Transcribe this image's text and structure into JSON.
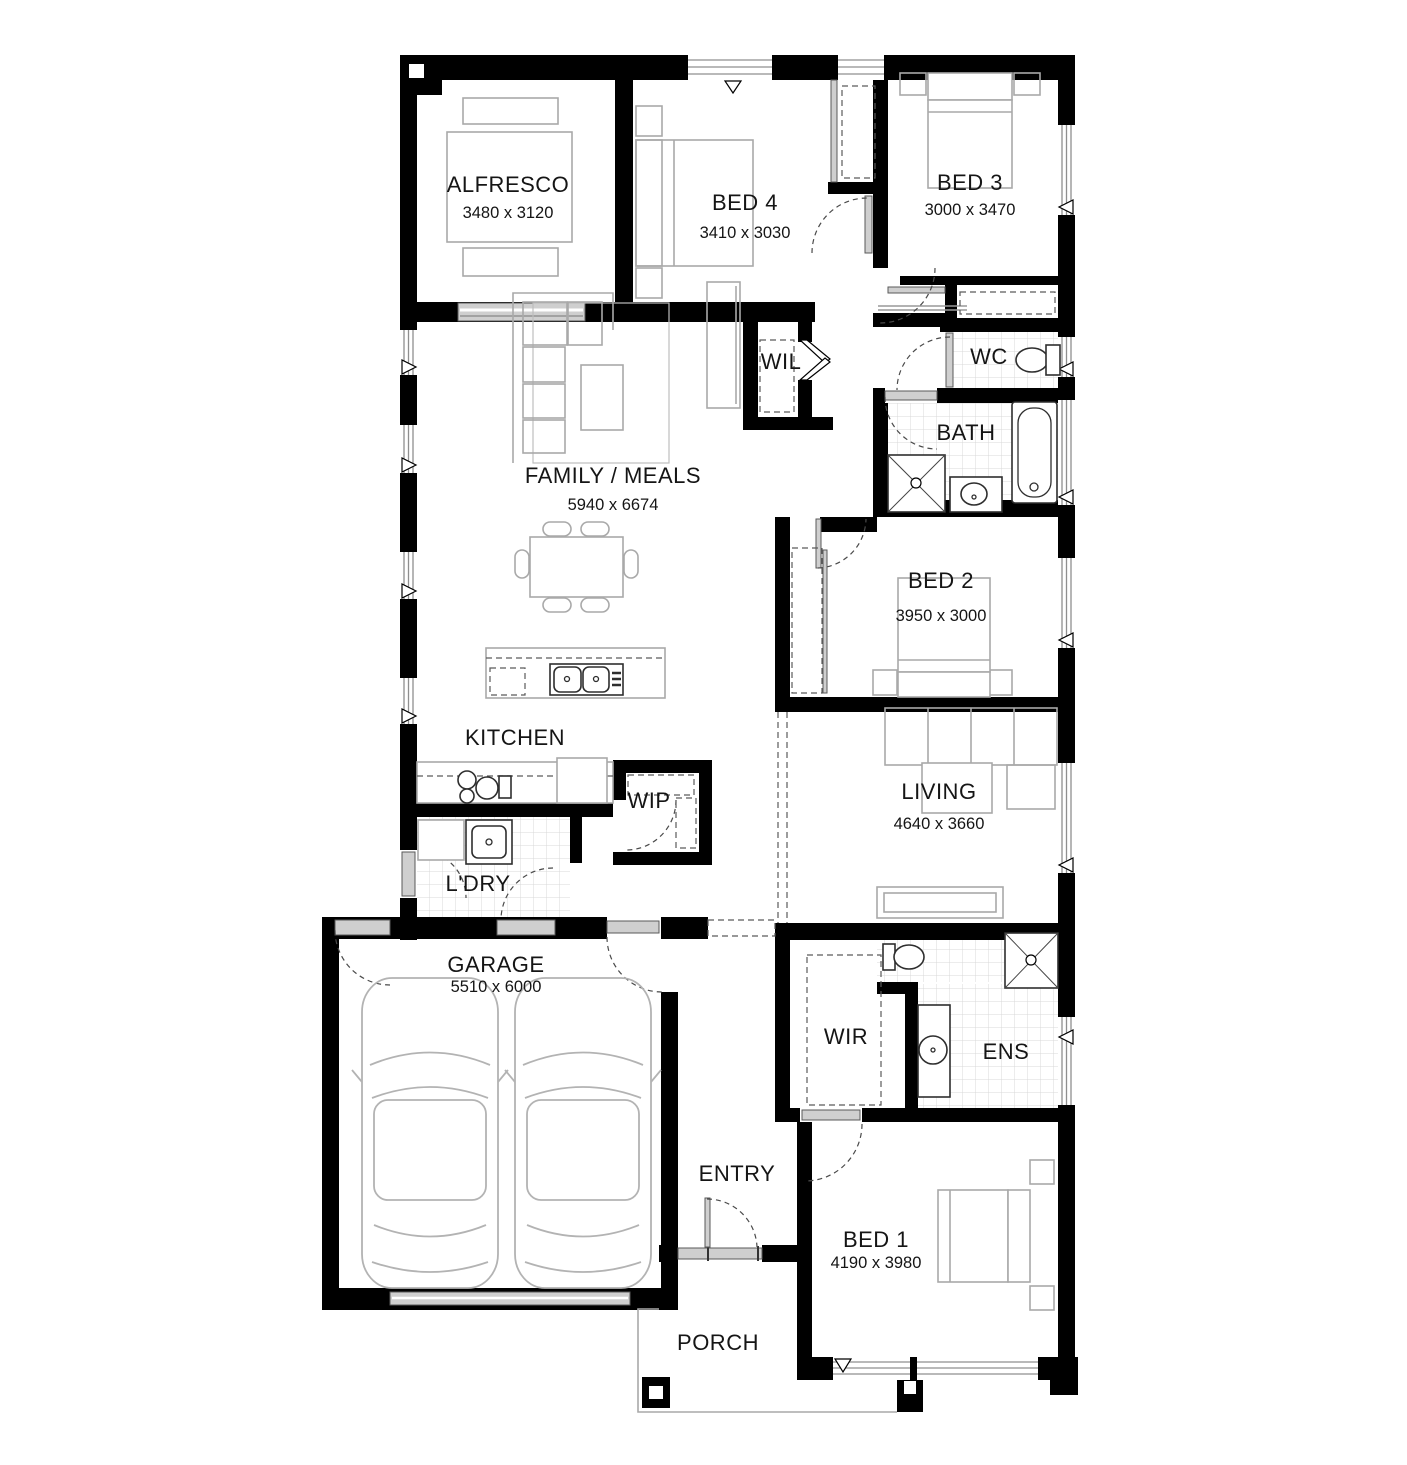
{
  "plan": {
    "type": "floor-plan",
    "rooms": {
      "alfresco": {
        "name": "ALFRESCO",
        "dims": "3480 x 3120"
      },
      "bed4": {
        "name": "BED 4",
        "dims": "3410 x 3030"
      },
      "bed3": {
        "name": "BED 3",
        "dims": "3000 x 3470"
      },
      "wil": {
        "name": "WIL"
      },
      "wc": {
        "name": "WC"
      },
      "bath": {
        "name": "BATH"
      },
      "family": {
        "name": "FAMILY / MEALS",
        "dims": "5940 x 6674"
      },
      "bed2": {
        "name": "BED 2",
        "dims": "3950 x 3000"
      },
      "kitchen": {
        "name": "KITCHEN"
      },
      "wip": {
        "name": "WIP"
      },
      "ldry": {
        "name": "L'DRY"
      },
      "living": {
        "name": "LIVING",
        "dims": "4640 x 3660"
      },
      "garage": {
        "name": "GARAGE",
        "dims": "5510 x 6000"
      },
      "wir": {
        "name": "WIR"
      },
      "ens": {
        "name": "ENS"
      },
      "entry": {
        "name": "ENTRY"
      },
      "bed1": {
        "name": "BED 1",
        "dims": "4190 x 3980"
      },
      "porch": {
        "name": "PORCH"
      }
    },
    "colors": {
      "wall": "#000000",
      "furniture": "#a9a9a9",
      "tile_line": "#d8d8d8",
      "door": "#cfcfcf"
    }
  }
}
